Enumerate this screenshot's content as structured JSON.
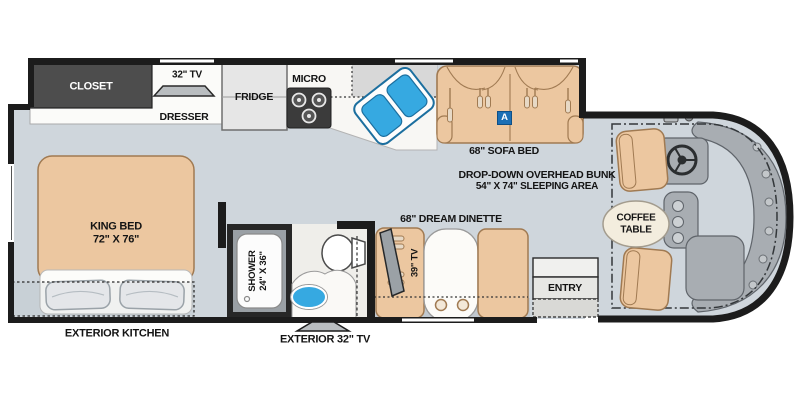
{
  "figure": {
    "type": "rv-floorplan-diagram"
  },
  "colors": {
    "floor": "#cfd6dc",
    "wall": "#1c1c1c",
    "furniture": "#ecc7a0",
    "furniture_outline": "#a07a52",
    "sink_blue": "#36a9e1",
    "badge_blue": "#1b6fb5",
    "counter_gray": "#d8d8d8",
    "cockpit_gray": "#a8adb2",
    "closet_gray": "#4d4d4d"
  },
  "labels": {
    "closet": "CLOSET",
    "tv_32": "32\" TV",
    "dresser": "DRESSER",
    "fridge": "FRIDGE",
    "micro": "MICRO",
    "sofa_bed": "68\" SOFA BED",
    "sofa_badge": "A",
    "bunk_line1": "DROP-DOWN OVERHEAD BUNK",
    "bunk_line2": "54\" X 74\" SLEEPING AREA",
    "king_bed_line1": "KING BED",
    "king_bed_line2": "72\" X 76\"",
    "shower_line1": "SHOWER",
    "shower_line2": "24\" X 36\"",
    "dream_dinette": "68\" DREAM DINETTE",
    "tv_39": "39\" TV",
    "entry": "ENTRY",
    "coffee_line1": "COFFEE",
    "coffee_line2": "TABLE",
    "exterior_kitchen": "EXTERIOR KITCHEN",
    "exterior_tv": "EXTERIOR 32\" TV"
  }
}
